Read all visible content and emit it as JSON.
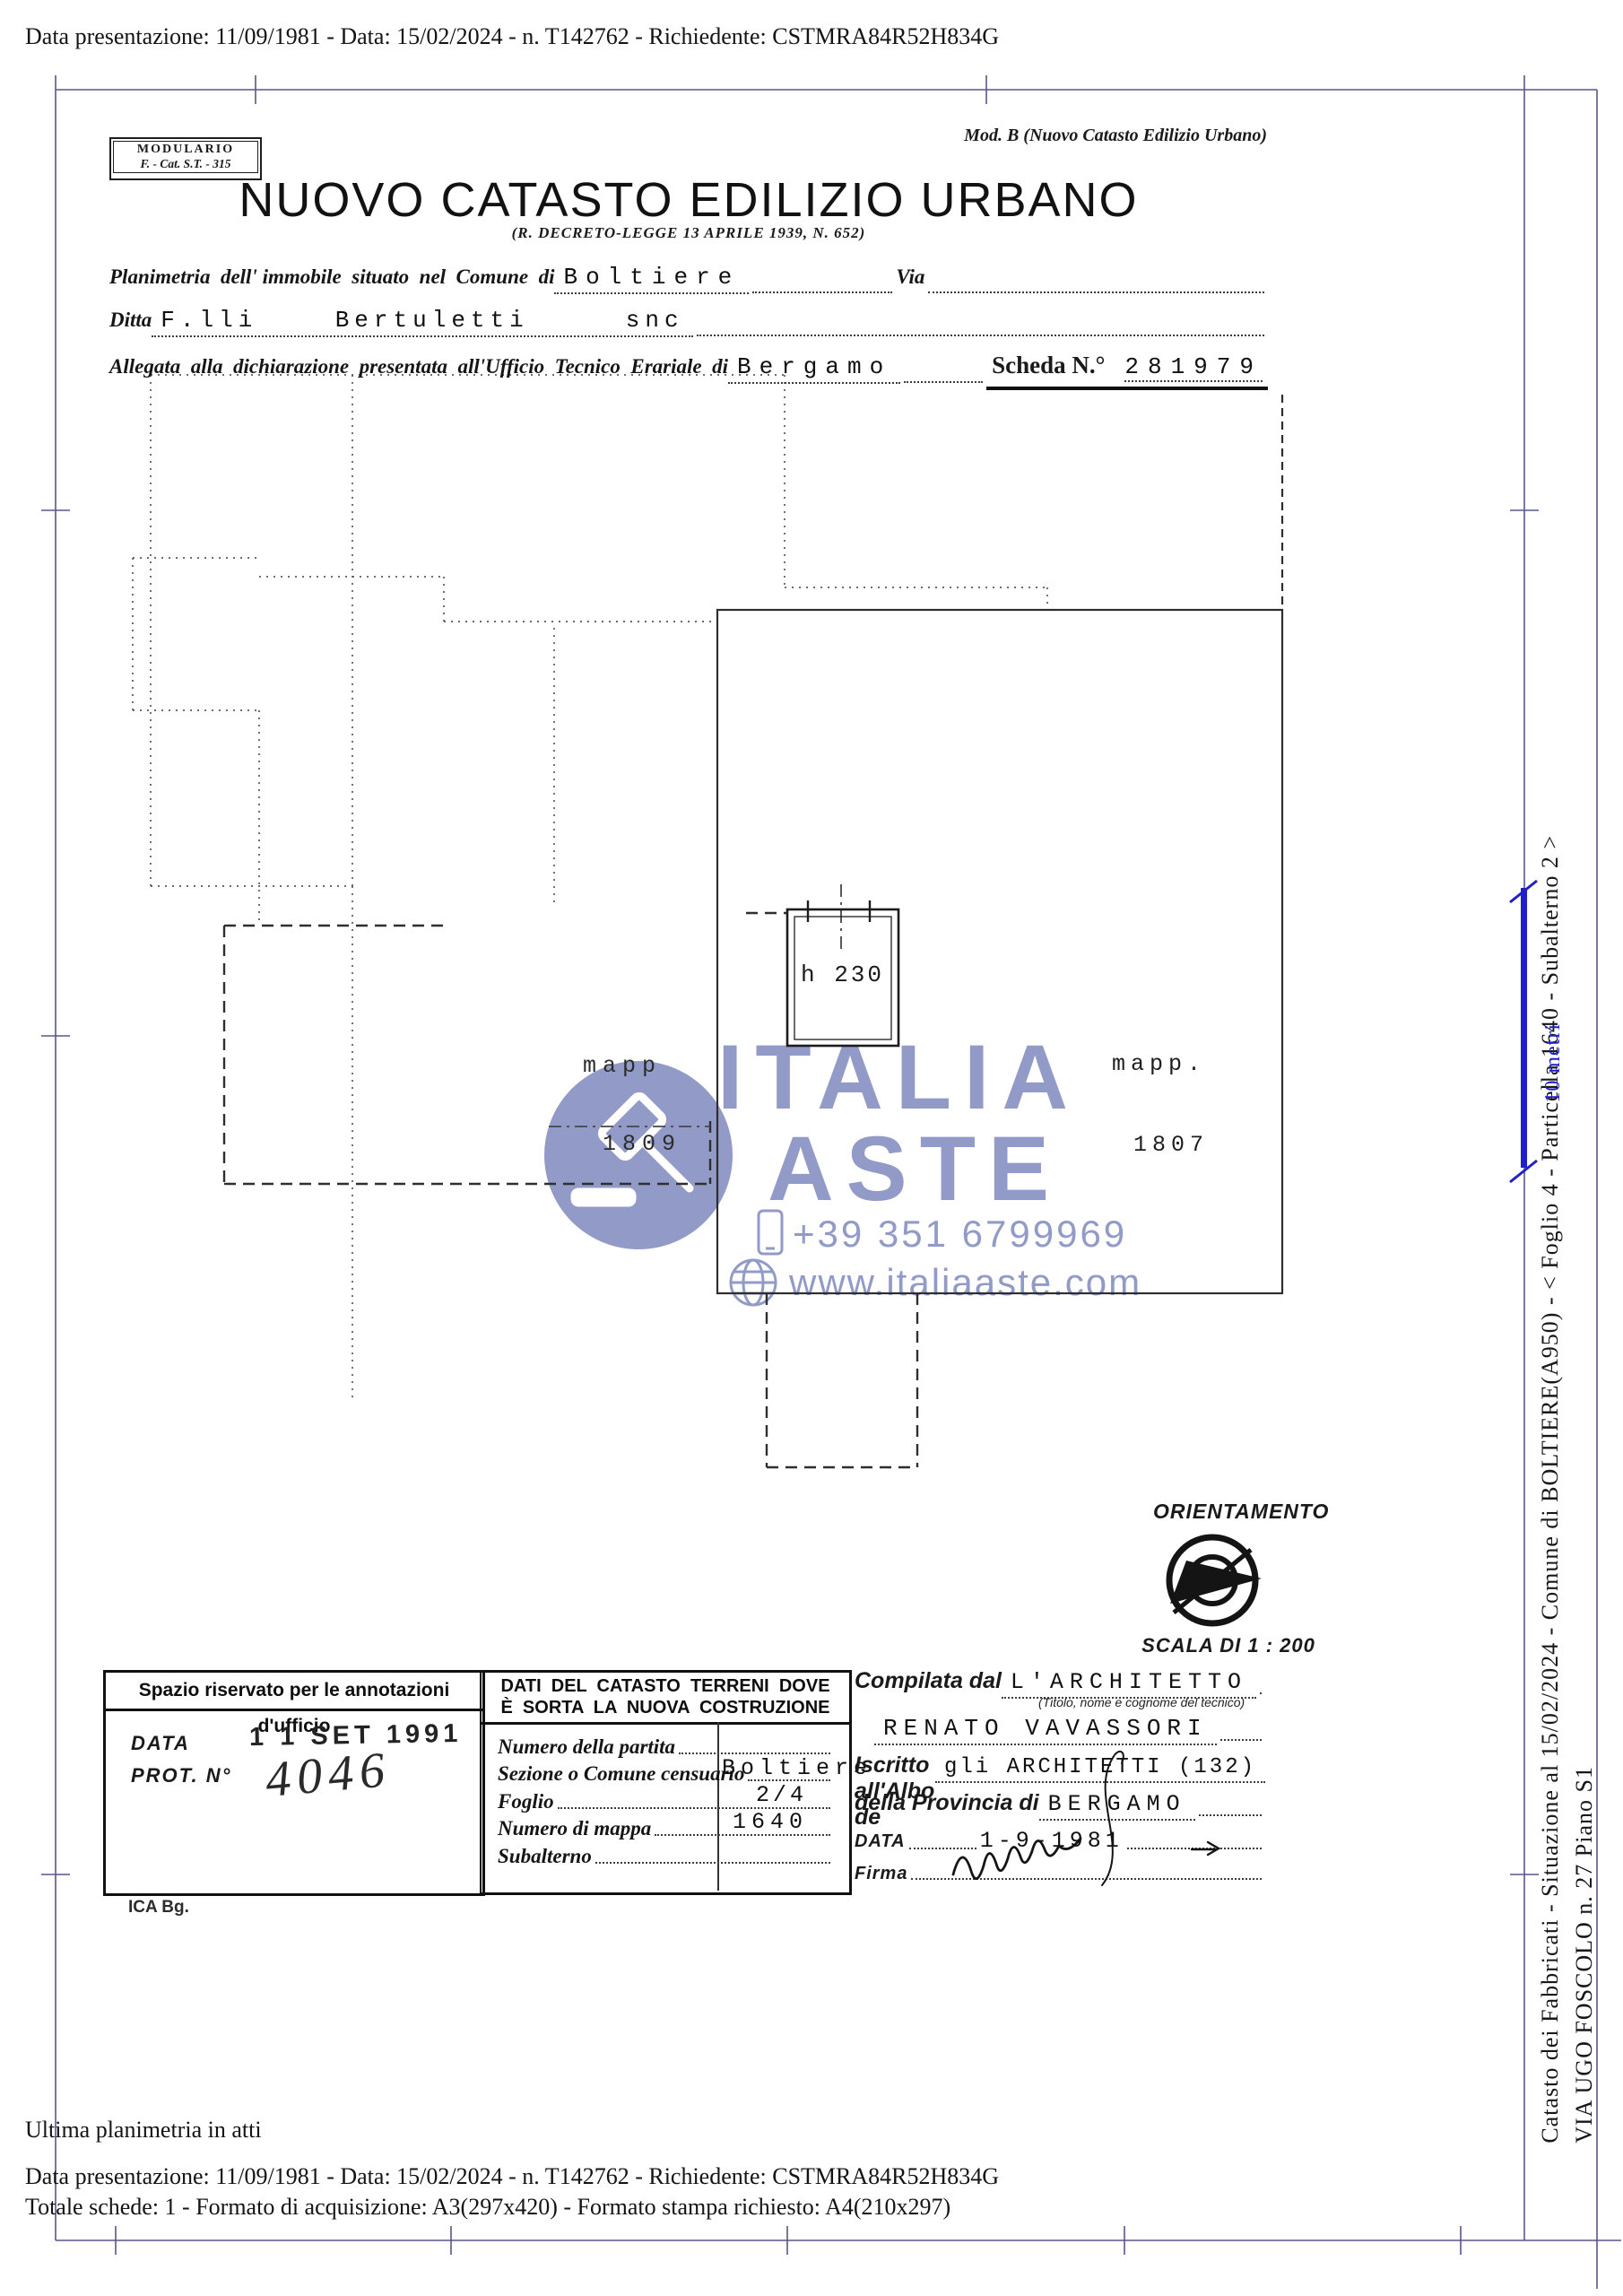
{
  "scan": {
    "top_line": "Data presentazione: 11/09/1981 - Data: 15/02/2024 - n. T142762 - Richiedente: CSTMRA84R52H834G",
    "footer_line1": "Ultima planimetria in atti",
    "footer_line2": "Data presentazione: 11/09/1981 - Data: 15/02/2024 - n. T142762 - Richiedente: CSTMRA84R52H834G",
    "footer_line3": "Totale schede: 1 - Formato di acquisizione: A3(297x420)  - Formato stampa richiesto: A4(210x297)"
  },
  "header": {
    "modulario_line1": "MODULARIO",
    "modulario_line2": "F. - Cat. S.T. - 315",
    "mod_b": "Mod. B (Nuovo Catasto Edilizio Urbano)",
    "title": "NUOVO CATASTO EDILIZIO URBANO",
    "subtitle": "(R. DECRETO-LEGGE 13 APRILE 1939, N. 652)",
    "planimetria_label": "Planimetria  dell' immobile  situato  nel  Comune  di",
    "comune_value": "Boltiere",
    "via_label": "Via",
    "ditta_label": "Ditta",
    "ditta_value": "F.lli    Bertuletti     snc",
    "allegata_label": "Allegata  alla  dichiarazione  presentata  all'Ufficio  Tecnico  Erariale  di",
    "ufficio_value": "Bergamo",
    "scheda_label": "Scheda N.°",
    "scheda_value": "281979"
  },
  "plan": {
    "mapp_left_line1": "mapp",
    "mapp_left_line2": "1809",
    "mapp_right_line1": "mapp.",
    "mapp_right_line2": "1807",
    "room_height_label": "h 230",
    "orientamento_label": "ORIENTAMENTO",
    "scala_label": "SCALA DI 1 : 200"
  },
  "watermark": {
    "brand_line1": "ITALIA",
    "brand_line2": "ASTE",
    "phone": "+39 351 6799969",
    "website": "www.italiaaste.com",
    "color": "#8d96c5"
  },
  "annotations_box": {
    "header": "Spazio riservato per le annotazioni d'ufficio",
    "data_label": "DATA",
    "data_stamp": "1 1 SET 1991",
    "prot_label": "PROT. N°",
    "prot_value": "4046",
    "ica": "ICA Bg."
  },
  "catasto_box": {
    "header_line1": "DATI  DEL  CATASTO  TERRENI  DOVE",
    "header_line2": "È  SORTA  LA  NUOVA  COSTRUZIONE",
    "fields": [
      {
        "label": "Numero della partita",
        "value": ""
      },
      {
        "label": "Sezione o Comune censuario",
        "value": "Boltiere"
      },
      {
        "label": "Foglio",
        "value": "2/4"
      },
      {
        "label": "Numero di mappa",
        "value": "1640"
      },
      {
        "label": "Subalterno",
        "value": ""
      }
    ]
  },
  "tecnico_box": {
    "compilata_label": "Compilata dal",
    "compilata_value": "L'ARCHITETTO",
    "caption": "(Titolo, nome e cognome del tecnico)",
    "name_value": "RENATO VAVASSORI",
    "albo_label": "Iscritto all'Albo de",
    "albo_value": "gli ARCHITETTI (132)",
    "provincia_label": "della Provincia di",
    "provincia_value": "BERGAMO",
    "data_label": "DATA",
    "data_value": "1-9-1981",
    "firma_label": "Firma"
  },
  "sidebar": {
    "scale_bar_label": "10 metri",
    "scale_bar_color": "#2020c8",
    "line1": "Catasto dei Fabbricati - Situazione al 15/02/2024 - Comune di BOLTIERE(A950) - <  Foglio 4 - Particella  1640 - Subalterno 2 >",
    "line2": "VIA UGO FOSCOLO n. 27 Piano S1"
  }
}
